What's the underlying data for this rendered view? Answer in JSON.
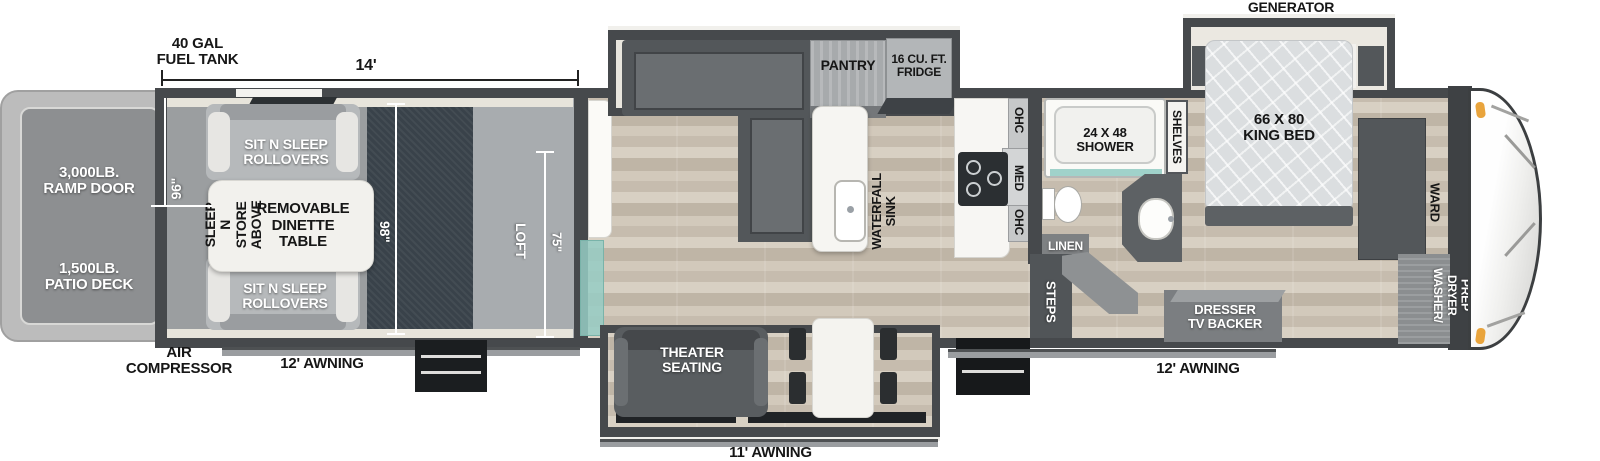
{
  "plan": {
    "exterior": {
      "fuel_tank": "40 GAL\nFUEL TANK",
      "garage_dim": "14'",
      "generator_prep": "GENERATOR\nPREP",
      "ramp_door": "3,000LB.\nRAMP DOOR",
      "patio_deck": "1,500LB.\nPATIO DECK",
      "air_compressor": "AIR\nCOMPRESSOR",
      "awning_garage": "12' AWNING",
      "awning_main": "11' AWNING",
      "awning_entry": "12' AWNING"
    },
    "garage": {
      "rollover_top": "SIT N SLEEP\nROLLOVERS",
      "rollover_bottom": "SIT N SLEEP\nROLLOVERS",
      "sleep_n_store": "SLEEP N STORE\nABOVE",
      "dinette": "REMOVABLE\nDINETTE\nTABLE",
      "dim_width": "96\"",
      "dim_length": "98\"",
      "loft": "LOFT",
      "loft_dim": "75\""
    },
    "living": {
      "pantry": "PANTRY",
      "fridge": "16 CU. FT.\nFRIDGE",
      "sink": "WATERFALL\nSINK",
      "theater": "THEATER\nSEATING"
    },
    "kitchen": {
      "ohc_upper": "OHC",
      "med": "MED",
      "ohc_lower": "OHC"
    },
    "bath": {
      "shower": "24 X 48\nSHOWER",
      "linen": "LINEN",
      "shelves": "SHELVES",
      "steps": "STEPS"
    },
    "bedroom": {
      "bed": "66 X 80\nKING BED",
      "ward": "WARD",
      "dresser": "DRESSER\nTV BACKER",
      "washer_dryer": "WASHER/\nDRYER\nPREP"
    },
    "colors": {
      "wall": "#46494c",
      "wood_floor": "#cfc6b8",
      "garage_floor": "#39424a",
      "loft_floor": "#a8acaf",
      "glass": "#9fd1c8",
      "marker_light": "#e9a43c",
      "awning": "#9a9da0"
    }
  }
}
